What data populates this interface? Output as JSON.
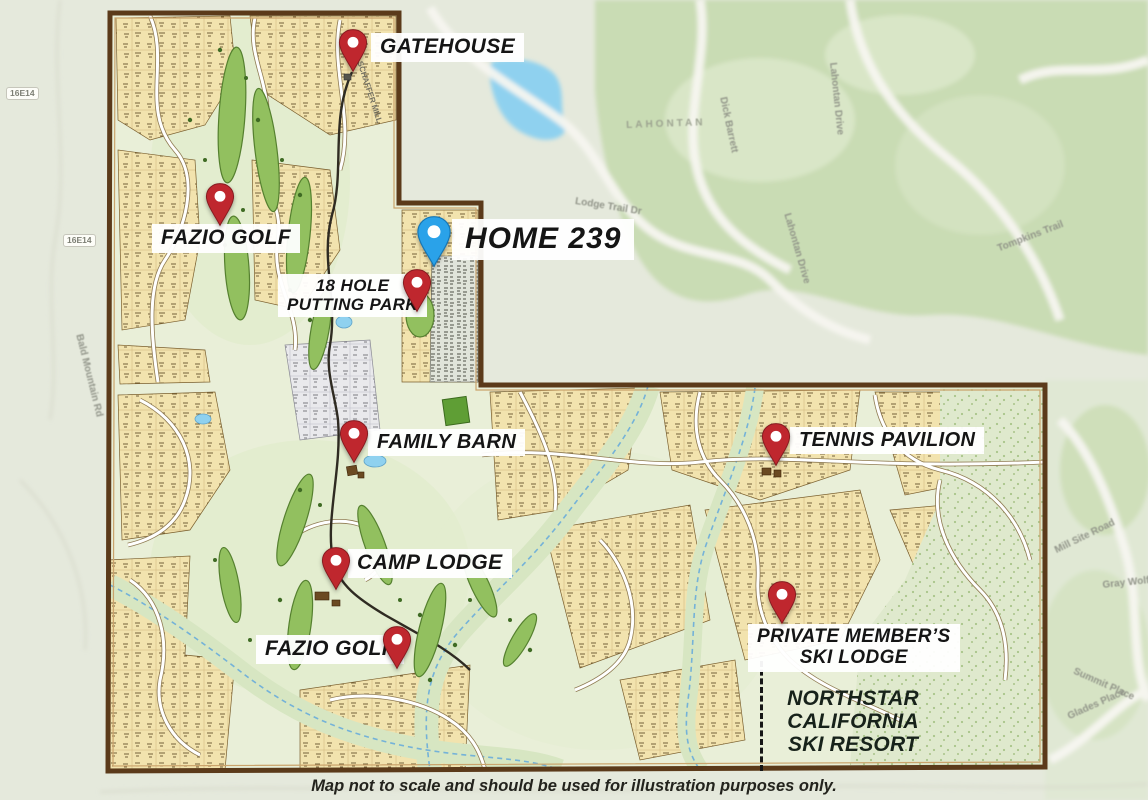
{
  "markers": {
    "gatehouse": {
      "label": "GATEHOUSE",
      "pin_color": "#bf272e"
    },
    "fazio_golf_north": {
      "label": "FAZIO GOLF",
      "pin_color": "#bf272e"
    },
    "home_239": {
      "label": "HOME 239",
      "pin_color": "#2aa2e9"
    },
    "putting_park": {
      "line1": "18 HOLE",
      "line2": "PUTTING PARK",
      "pin_color": "#bf272e"
    },
    "family_barn": {
      "label": "FAMILY BARN",
      "pin_color": "#bf272e"
    },
    "tennis_pavilion": {
      "label": "TENNIS PAVILION",
      "pin_color": "#bf272e"
    },
    "camp_lodge": {
      "label": "CAMP LODGE",
      "pin_color": "#bf272e"
    },
    "fazio_golf_south": {
      "label": "FAZIO GOLF",
      "pin_color": "#bf272e"
    },
    "ski_lodge": {
      "line1": "PRIVATE MEMBER’S",
      "line2": "SKI LODGE",
      "pin_color": "#bf272e"
    }
  },
  "area_labels": {
    "northstar": {
      "line1": "NORTHSTAR",
      "line2": "CALIFORNIA",
      "line3": "SKI RESORT"
    },
    "lahontan": "LAHONTAN"
  },
  "road_labels": {
    "bald_mountain": "Bald Mountain Rd",
    "trail_16e14_a": "16E14",
    "trail_16e14_b": "16E14",
    "schaffer_mill": "SCHAFFER MILL",
    "lodge_trail": "Lodge Trail Dr",
    "dick_barrett": "Dick Barrett",
    "lahontan_drive_a": "Lahontan Drive",
    "lahontan_drive_b": "Lahontan Drive",
    "tompkins_trail": "Tompkins Trail",
    "mill_site_road": "Mill Site Road",
    "gray_wolf": "Gray Wolf",
    "summit_place": "Summit Place",
    "glades_place": "Glades Place"
  },
  "disclaimer": "Map not to scale and should be used for illustration purposes only.",
  "colors": {
    "boundary_brown": "#5b3a1a",
    "interior_green": "#e9efd8",
    "parcel_tan": "#f2e3ae",
    "fairway_green": "#92c05f",
    "water_blue": "#8fd1ef",
    "pin_red": "#bf272e",
    "pin_blue": "#2aa2e9",
    "label_bg": "#ffffff",
    "label_text": "#151515"
  }
}
